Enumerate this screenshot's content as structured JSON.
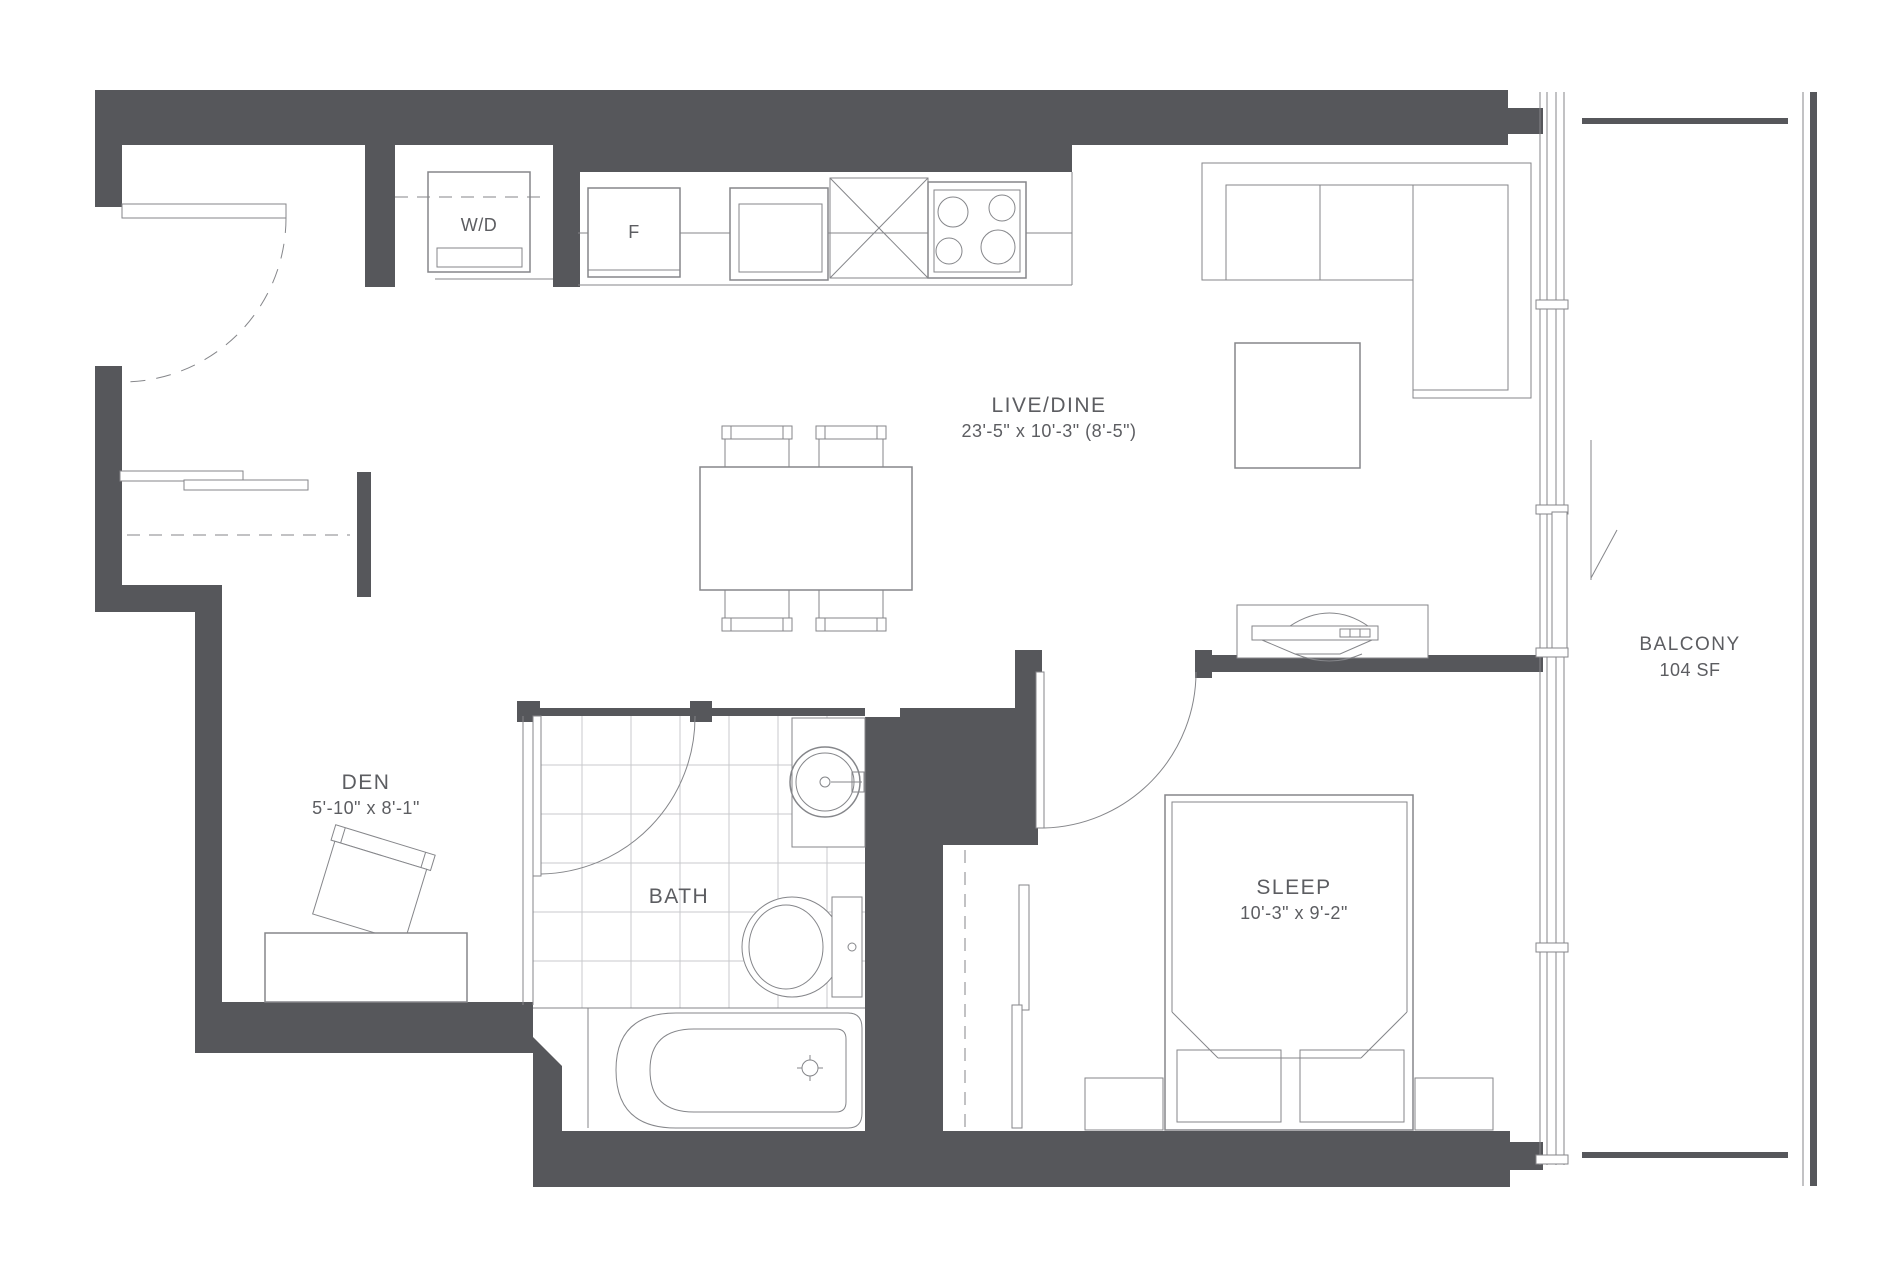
{
  "colors": {
    "wall": "#56575b",
    "line": "#85868a",
    "tile": "#c9cacc",
    "text": "#5c5d61",
    "bg": "#ffffff"
  },
  "rooms": {
    "live_dine": {
      "name": "LIVE/DINE",
      "dims": "23'-5\" x 10'-3\" (8'-5\")"
    },
    "den": {
      "name": "DEN",
      "dims": "5'-10\" x 8'-1\""
    },
    "bath": {
      "name": "BATH"
    },
    "sleep": {
      "name": "SLEEP",
      "dims": "10'-3\" x 9'-2\""
    },
    "balcony": {
      "name": "BALCONY",
      "area": "104 SF"
    }
  },
  "appliances": {
    "washer_dryer": "W/D",
    "fridge": "F"
  }
}
